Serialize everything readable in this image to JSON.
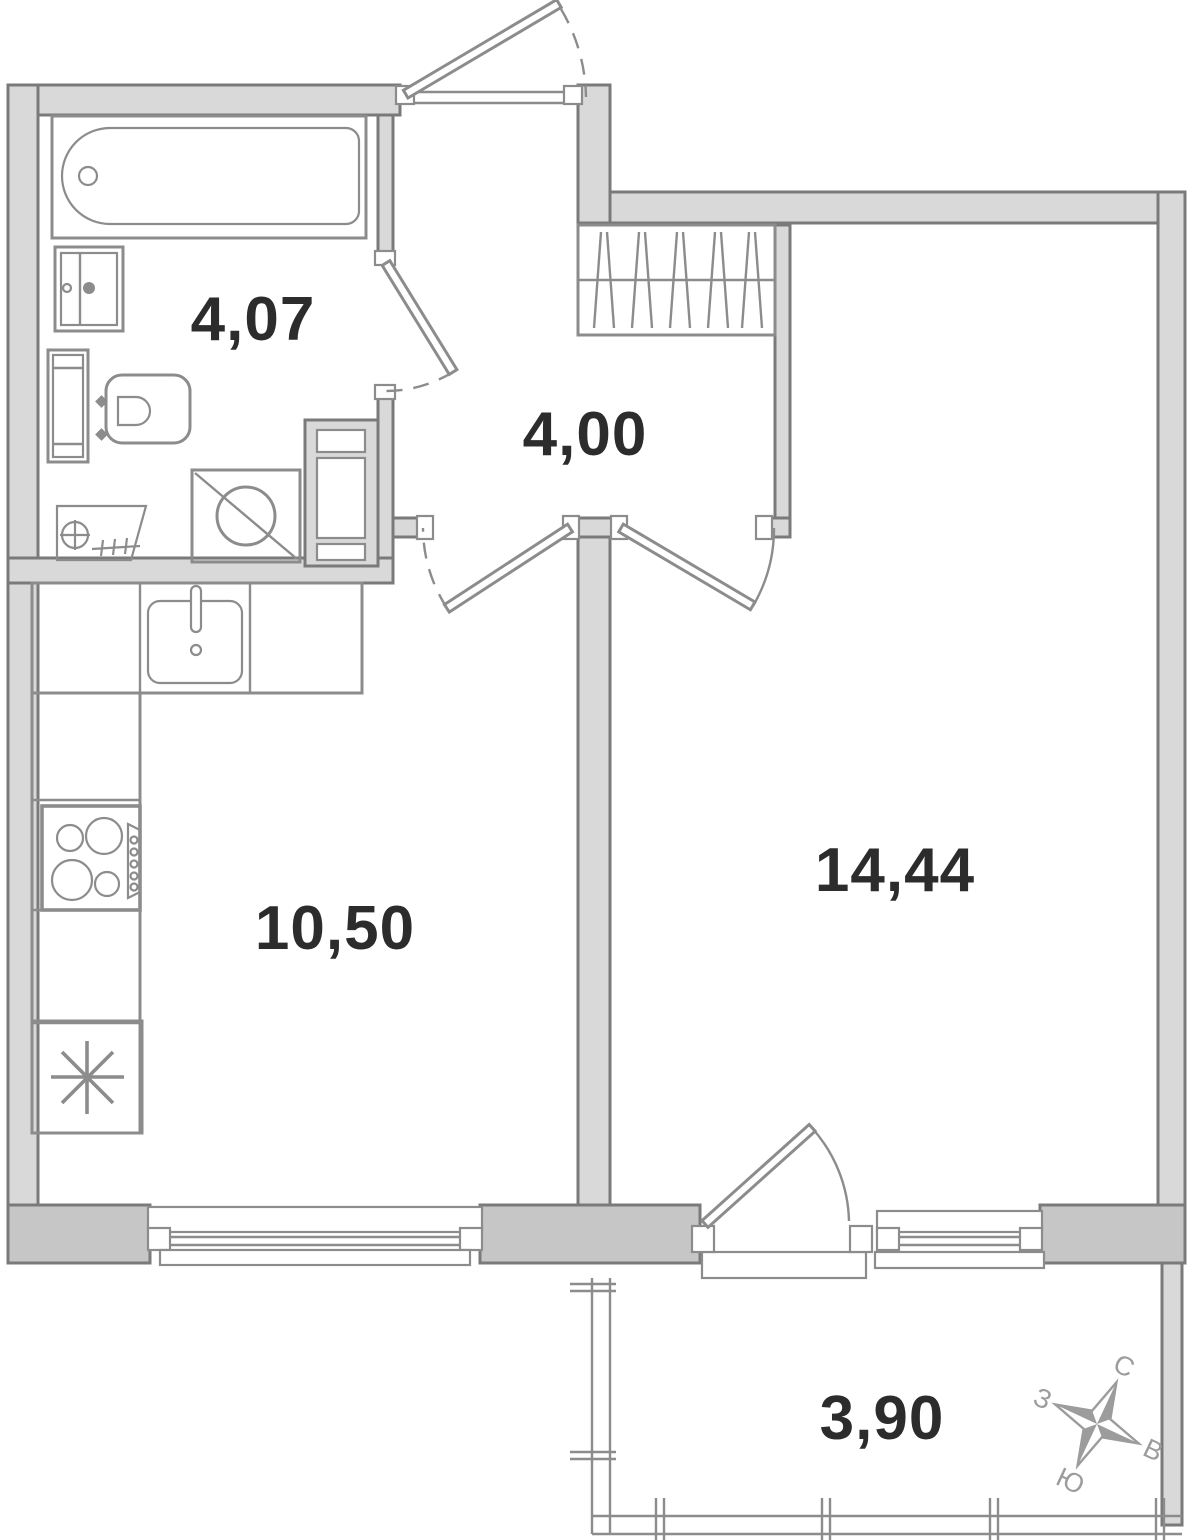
{
  "rooms": {
    "bathroom": {
      "area": "4,07"
    },
    "hallway": {
      "area": "4,00"
    },
    "kitchen": {
      "area": "10,50"
    },
    "living_room": {
      "area": "14,44"
    },
    "balcony": {
      "area": "3,90"
    }
  },
  "compass": {
    "north": "С",
    "east": "В",
    "south": "Ю",
    "west": "З"
  },
  "icons": {
    "bathtub": "bathtub-symbol",
    "sink": "washbasin-symbol",
    "toilet": "toilet-symbol",
    "towel_rail": "towel-rail-symbol",
    "washing_machine": "circle-crossed-square",
    "vent_shaft": "shaft-symbol",
    "kitchen_sink": "sink-with-faucet",
    "stove": "four-burner-cooktop",
    "fridge": "snowflake-asterisk",
    "wardrobe": "hatched-closet",
    "compass_rose": "four-point-star"
  },
  "colors": {
    "background": "#ffffff",
    "wall_fill": "#d9d9d9",
    "wall_fill_dark": "#c6c6c6",
    "outline": "#7a7a7a",
    "fixture": "#8c8c8c",
    "label_text": "#2c2c2c",
    "compass": "#9c9c9c"
  }
}
